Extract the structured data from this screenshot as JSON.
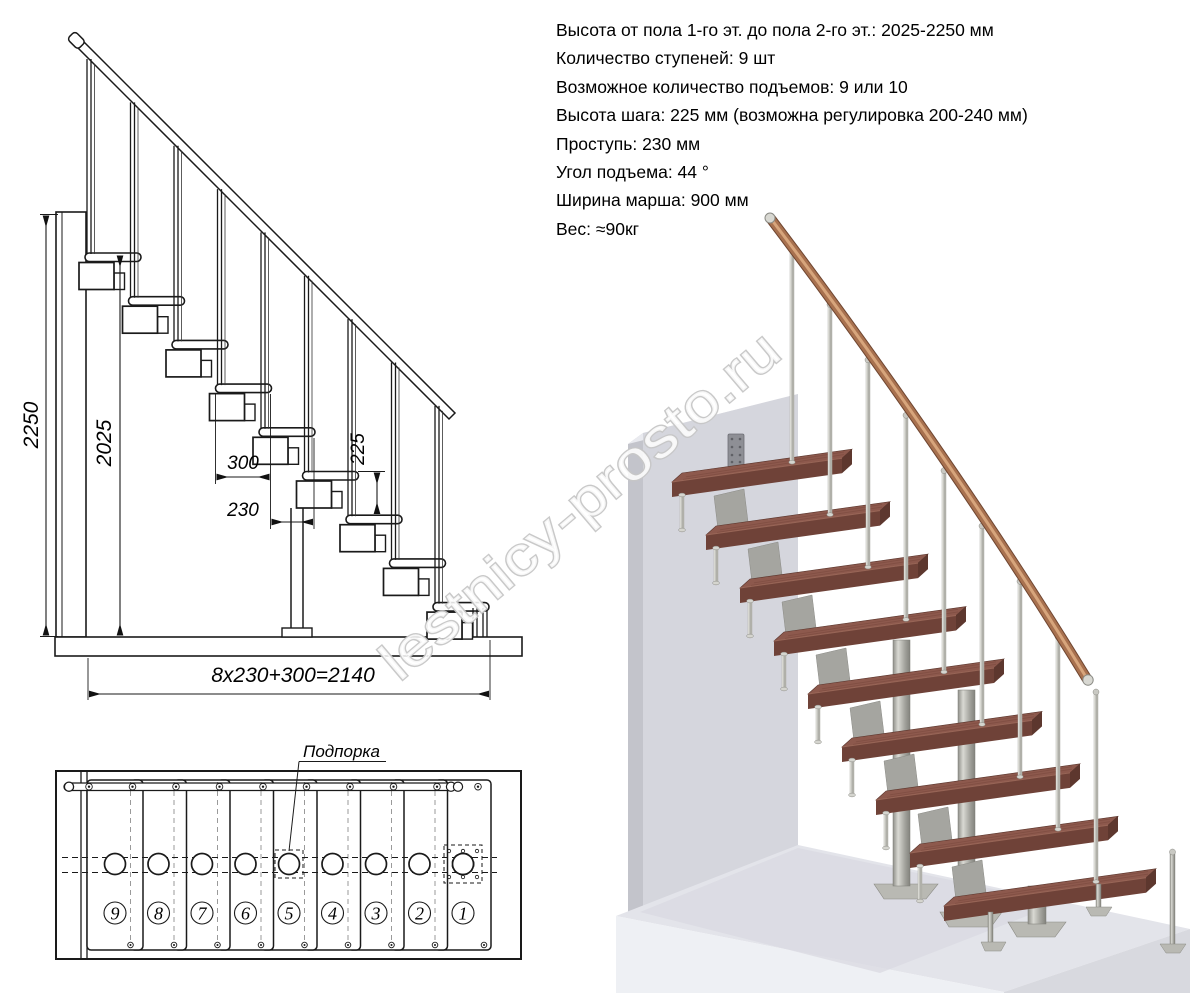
{
  "specs": {
    "lines": [
      "Высота от пола 1-го эт. до пола 2-го эт.: 2025-2250 мм",
      "Количество ступеней: 9 шт",
      "Возможное количество подъемов: 9 или 10",
      "Высота шага: 225 мм (возможна регулировка 200-240 мм)",
      "Проступь: 230 мм",
      "Угол подъема: 44 °",
      "Ширина марша: 900 мм",
      "Вес: ≈90кг"
    ]
  },
  "side_view": {
    "dims": {
      "total_height": "2250",
      "floor_height": "2025",
      "tread_width": "300",
      "step_run": "230",
      "step_rise": "225",
      "total_run": "8x230+300=2140"
    }
  },
  "plan_view": {
    "support_label": "Подпорка",
    "step_numbers": [
      "9",
      "8",
      "7",
      "6",
      "5",
      "4",
      "3",
      "2",
      "1"
    ]
  },
  "render_3d": {
    "watermark": "lestnicy-prosto.ru"
  },
  "colors": {
    "line": "#1a1a1a",
    "tread_top": "#8d594d",
    "tread_front": "#6f4238",
    "tread_side": "#5d372e",
    "rail_wood": "#a8714f",
    "rail_wood_light": "#d9a87e",
    "metal": "#b0b0a9",
    "metal_light": "#e3e3dd",
    "metal_dark": "#8a8a84",
    "wall_front": "#d5d6dd",
    "wall_side": "#c3c4cb",
    "wall_top": "#e9eaef",
    "floor_top": "#e3e4ea",
    "floor_front": "#eef0f4",
    "floor_side": "#d8d9df",
    "watermark_outline": "#c6c6c6"
  }
}
